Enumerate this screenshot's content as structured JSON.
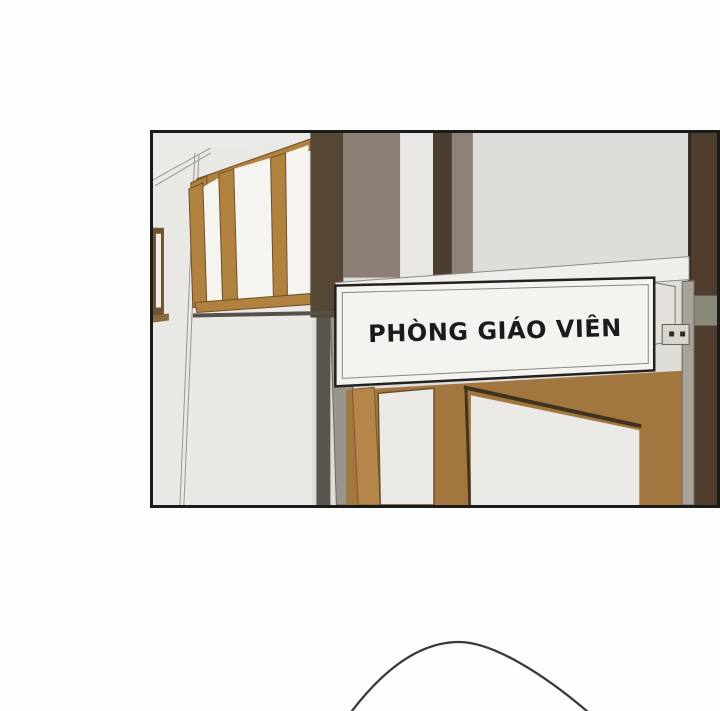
{
  "page": {
    "background": "#fdfdfc",
    "type": "comic-page-excerpt"
  },
  "panel": {
    "border_color": "#1b1b1b",
    "scene": {
      "description": "school hallway with wooden windows, dark pillars and teachers room door",
      "wall_light": "#dfddda",
      "wall_white": "#eae8e5",
      "wall_white_top": "#eceae7",
      "pillar_dark": "#564636",
      "stripe_dark": "#4c3d31",
      "pillar_right": "#4f3e30",
      "pillar_right_edge": "#33281f",
      "band_taupe": "#8c8076",
      "band_taupe2": "#8d8178",
      "sliver_white": "#e9e7e4",
      "window_frame_tan": "#b0813f",
      "window_frame_edge": "#6e5026",
      "window_pane": "#f6f4f0",
      "partial_window_dark": "#6e5433",
      "sill_dark": "#55504a",
      "beam_white": "#f0eeea",
      "door_brown": "#a1763f",
      "door_trim_tan": "#b5854a",
      "door_pane_white": "#ebe9e5",
      "door_edge_dark": "#42331f",
      "shadow_strip": "#59544d",
      "metal_gray": "#9a958c",
      "metal_gray_right": "#a8a298",
      "metal_band_green": "#8a8877",
      "bracket_gray": "#d9d6d0",
      "screw_dark": "#2e2b27"
    },
    "sign": {
      "display_text": "PHÒNG GIÁO VIÊN",
      "meaning": "Teachers' room",
      "background": "#f5f3f0",
      "side_face": "#e3e0db",
      "border_color": "#22211f",
      "inner_line_color": "#8a8681",
      "text_color": "#1c1b19"
    }
  },
  "next_panel": {
    "head_outline_color": "#3a3a3a"
  }
}
